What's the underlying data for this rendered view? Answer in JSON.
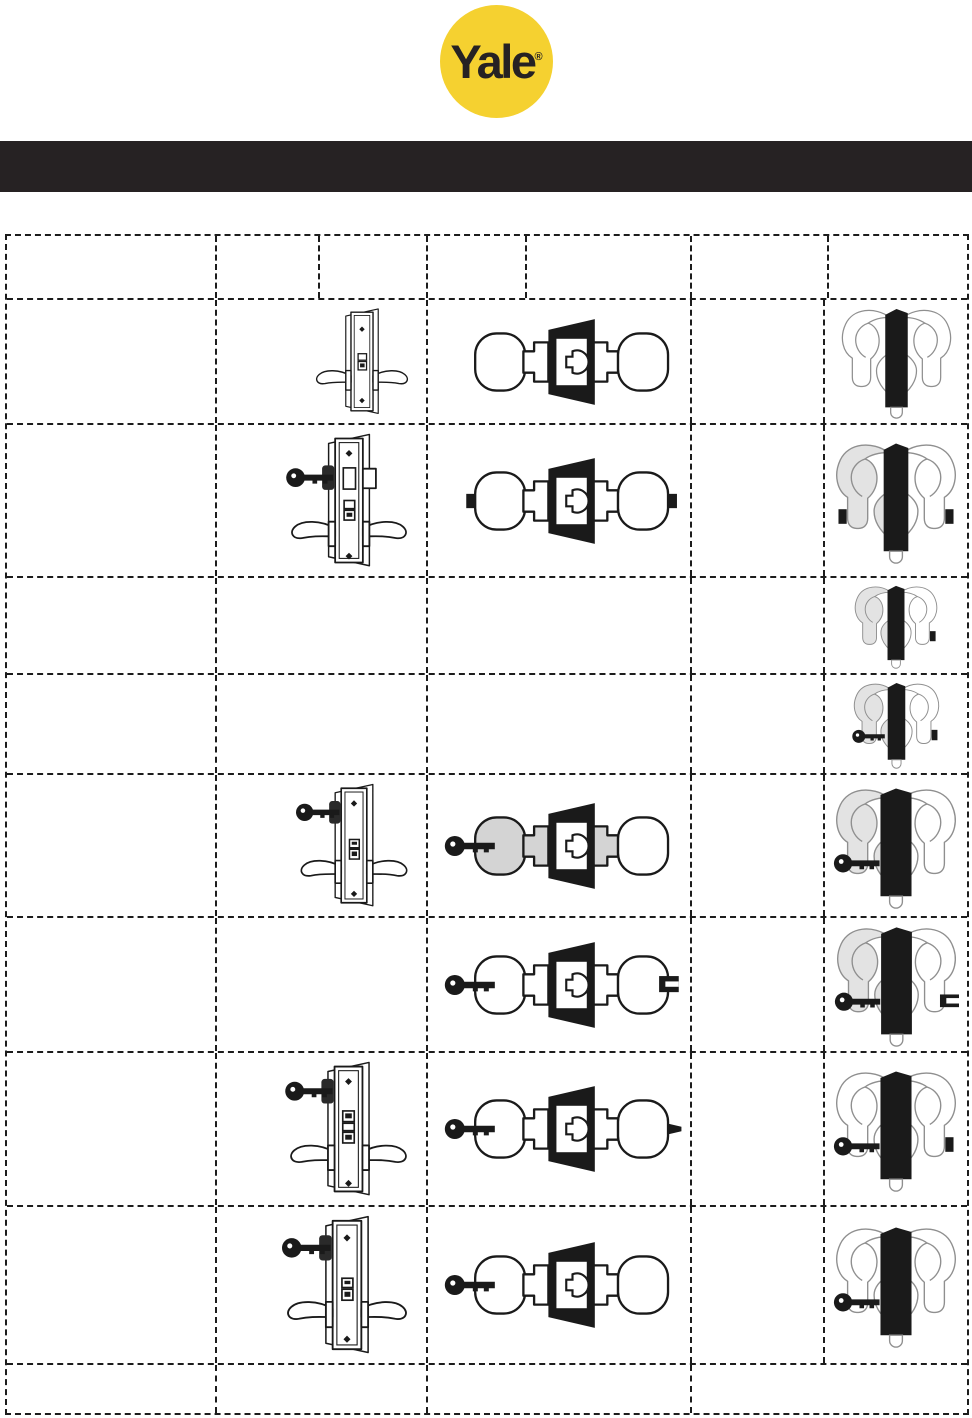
{
  "logo": {
    "text": "Yale",
    "registered": "®",
    "circle_color": "#F5D130",
    "text_color": "#262223"
  },
  "banner": {
    "color": "#262223"
  },
  "table": {
    "border_color": "#1c1c1c",
    "header": {
      "height": 64,
      "cells": [
        "",
        "",
        "",
        "",
        "",
        "",
        ""
      ]
    },
    "rows": [
      {
        "height": 125,
        "function_text": "",
        "lock_body": {
          "variant": "plain",
          "key": null
        },
        "knob": {
          "key": null,
          "buttons": null,
          "slot": null,
          "pin": null,
          "left_shaded": false
        },
        "lever": {
          "key": null,
          "buttons": null,
          "button": null,
          "slot": null,
          "left_shaded": false,
          "wide_bar": false
        }
      },
      {
        "height": 153,
        "function_text": "",
        "lock_body": {
          "variant": "deadbolt",
          "key": "side"
        },
        "knob": {
          "key": null,
          "buttons": "both",
          "slot": null,
          "pin": null,
          "left_shaded": false
        },
        "lever": {
          "key": null,
          "buttons": "both",
          "button": null,
          "slot": null,
          "left_shaded": true,
          "wide_bar": false
        }
      },
      {
        "height": 97,
        "function_text": "",
        "lock_body": null,
        "knob": null,
        "lever": {
          "key": null,
          "buttons": null,
          "button": "right",
          "slot": null,
          "left_shaded": true,
          "wide_bar": false
        }
      },
      {
        "height": 100,
        "function_text": "",
        "lock_body": null,
        "knob": null,
        "lever": {
          "key": "left",
          "buttons": null,
          "button": "right",
          "slot": null,
          "left_shaded": true,
          "wide_bar": false
        }
      },
      {
        "height": 143,
        "function_text": "",
        "lock_body": {
          "variant": "standard",
          "key": "top"
        },
        "knob": {
          "key": "left",
          "buttons": null,
          "slot": null,
          "pin": null,
          "left_shaded": true
        },
        "lever": {
          "key": "left",
          "buttons": null,
          "button": null,
          "slot": null,
          "left_shaded": true,
          "wide_bar": true
        }
      },
      {
        "height": 135,
        "function_text": "",
        "lock_body": null,
        "knob": {
          "key": "left",
          "buttons": null,
          "slot": "right",
          "pin": null,
          "left_shaded": false
        },
        "lever": {
          "key": "left",
          "buttons": null,
          "button": null,
          "slot": "right",
          "left_shaded": true,
          "wide_bar": true
        }
      },
      {
        "height": 154,
        "function_text": "",
        "lock_body": {
          "variant": "triple-latch",
          "key": "top"
        },
        "knob": {
          "key": "left",
          "buttons": null,
          "slot": null,
          "pin": "right",
          "left_shaded": false
        },
        "lever": {
          "key": "left",
          "buttons": null,
          "button": "right",
          "slot": null,
          "left_shaded": false,
          "wide_bar": true
        }
      },
      {
        "height": 158,
        "function_text": "",
        "lock_body": {
          "variant": "standard",
          "key": "top"
        },
        "knob": {
          "key": "left",
          "buttons": null,
          "slot": null,
          "pin": null,
          "left_shaded": false
        },
        "lever": {
          "key": "left",
          "buttons": null,
          "button": null,
          "slot": null,
          "left_shaded": false,
          "wide_bar": true
        }
      }
    ],
    "footer": {
      "height": 48,
      "cells": [
        "",
        "",
        "",
        ""
      ]
    }
  }
}
